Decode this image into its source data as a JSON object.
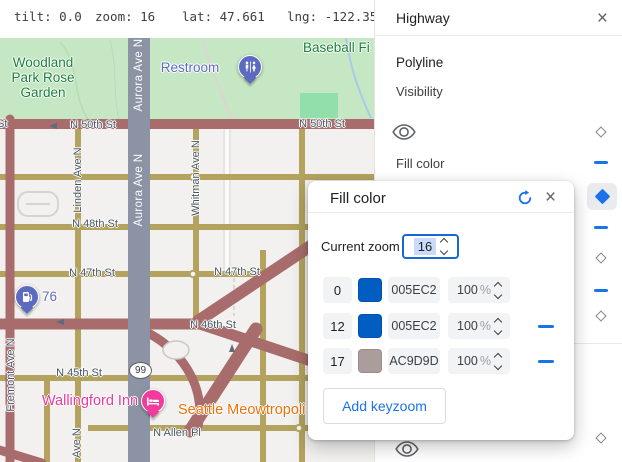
{
  "status_bar": {
    "tilt": "tilt: 0.0",
    "zoom": "zoom: 16",
    "lat": "lat: 47.661",
    "lng": "lng: -122.356"
  },
  "sidebar": {
    "title": "Highway",
    "section": "Polyline",
    "visibility_label": "Visibility",
    "fill_color_label": "Fill color"
  },
  "dialog": {
    "title": "Fill color",
    "current_zoom_label": "Current zoom",
    "current_zoom_value": "16",
    "opacity_suffix": "%",
    "keyzooms": [
      {
        "zoom": "0",
        "hex_label": "005EC2",
        "color": "#005EC2",
        "opacity": "100"
      },
      {
        "zoom": "12",
        "hex_label": "005EC2",
        "color": "#005EC2",
        "opacity": "100"
      },
      {
        "zoom": "17",
        "hex_label": "AC9D9D",
        "color": "#AC9D9D",
        "opacity": "100"
      }
    ],
    "add_button_label": "Add keyzoom"
  },
  "icons": {
    "close": "×",
    "refresh": "circular-arrow",
    "visibility": "eye",
    "keyframe_marker": "diamond",
    "remove_keyframe": "minus-dash"
  },
  "map": {
    "street_labels": {
      "n50": "N 50th St",
      "n48": "N 48th St",
      "n47": "N 47th St",
      "n46": "N 46th St",
      "n45": "N 45th St",
      "allen": "N Allen Pl",
      "aurora": "Aurora Ave N",
      "linden": "Linden Ave N",
      "whitman": "Whitman Ave N",
      "fremont": "Fremont Ave N",
      "ave_n_fragment": "Ave N",
      "st_fragment": "St"
    },
    "pois": {
      "park_line1": "Woodland",
      "park_line2": "Park Rose",
      "park_line3": "Garden",
      "baseball": "Baseball Fi",
      "restroom": "Restroom",
      "gas": "76",
      "route_shield": "99",
      "cat_cafe": "Seattle Meowtropoli",
      "hotel": "Wallingford Inn"
    },
    "colors": {
      "background": "#f2f1ef",
      "park": "#c6e7c3",
      "ballfield": "#93dfab",
      "highway_road": "#a96c6c",
      "arterial_road": "#b3a35e",
      "aurora_road": "#8b93a4",
      "park_label_green": "#188038",
      "poi_indigo": "#5c6bc0",
      "poi_orange": "#e8710a",
      "poi_pink": "#e8399b",
      "accent_blue": "#1a73e8"
    }
  }
}
